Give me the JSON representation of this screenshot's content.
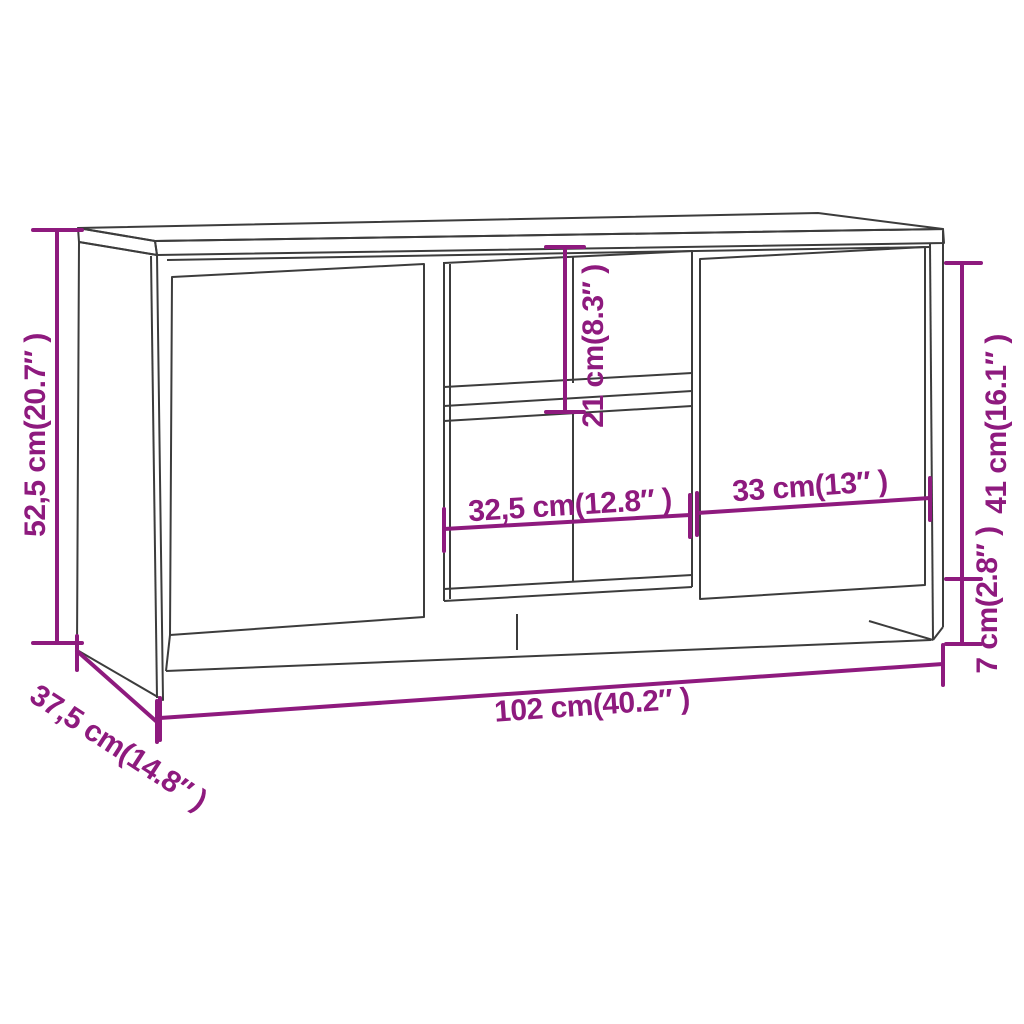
{
  "figure": {
    "type": "product-dimension-diagram",
    "subject": "TV cabinet line drawing with two doors, open middle shelves and plinth",
    "background_color": "#ffffff",
    "accent_color": "#8E1A7E",
    "outline_color": "#3C3C3C"
  },
  "dimensions": [
    {
      "id": "overall-height",
      "label": "52,5 cm(20.7″ )",
      "cm": "52,5",
      "inches": "20.7″",
      "orientation": "vertical-left"
    },
    {
      "id": "depth",
      "label": "37,5 cm(14.8″ )",
      "cm": "37,5",
      "inches": "14.8″",
      "orientation": "diagonal-bottom-left"
    },
    {
      "id": "overall-width",
      "label": "102 cm(40.2″ )",
      "cm": "102",
      "inches": "40.2″",
      "orientation": "horizontal-bottom"
    },
    {
      "id": "shelf-opening-height",
      "label": "21 cm(8.3″ )",
      "cm": "21",
      "inches": "8.3″",
      "orientation": "vertical-middle"
    },
    {
      "id": "door-height",
      "label": "41 cm(16.1″ )",
      "cm": "41",
      "inches": "16.1″",
      "orientation": "vertical-right"
    },
    {
      "id": "plinth-height",
      "label": "7 cm(2.8″ )",
      "cm": "7",
      "inches": "2.8″",
      "orientation": "vertical-right-lower"
    },
    {
      "id": "opening-width",
      "label": "32,5 cm(12.8″ )",
      "cm": "32,5",
      "inches": "12.8″",
      "orientation": "horizontal-middle-left"
    },
    {
      "id": "door-width",
      "label": "33 cm(13″ )",
      "cm": "33",
      "inches": "13″",
      "orientation": "horizontal-middle-right"
    }
  ]
}
